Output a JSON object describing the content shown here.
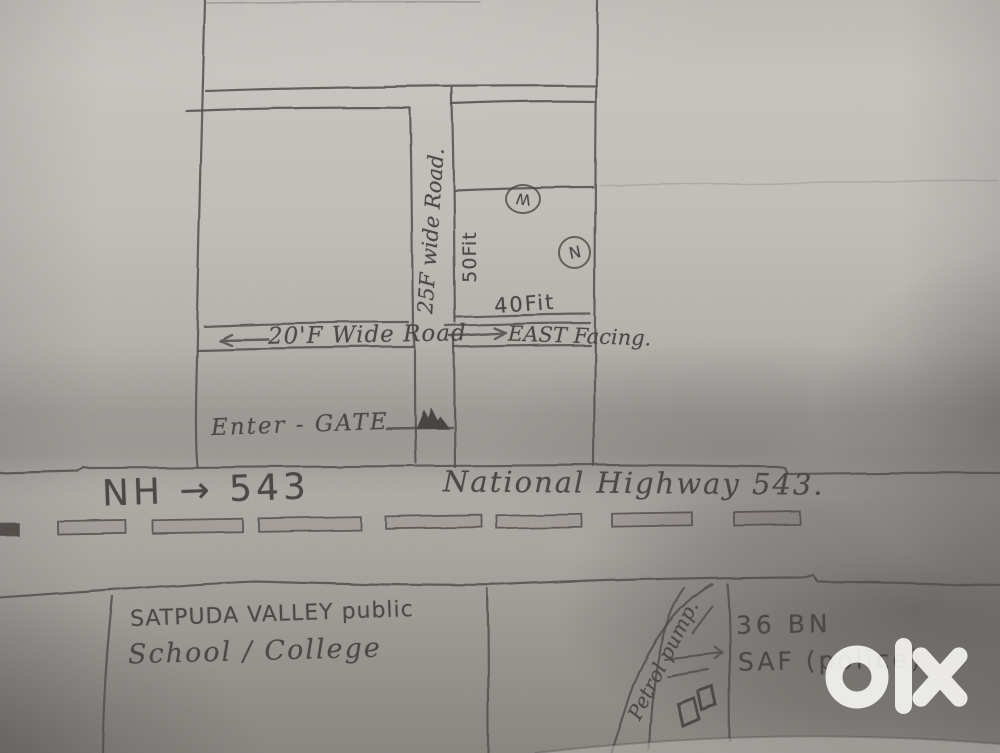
{
  "map": {
    "upper": {
      "vertical_road_label": "25F wide Road.",
      "depth_label": "50Fit",
      "width_label": "40Fit",
      "compass_west": "W",
      "compass_north": "N"
    },
    "middle_road": {
      "label": "20'F Wide Road",
      "facing_label": "EAST Facing.",
      "gate_label": "Enter - GATE"
    },
    "highway": {
      "short_label": "NH → 543",
      "full_label": "National Highway 543."
    },
    "bottom": {
      "school_line1": "SATPUDA VALLEY public",
      "school_line2": "School / College",
      "petrol_label": "Petrol pump.",
      "unit_line1": "36 BN",
      "unit_line2": "SAF (police)"
    },
    "watermark_logo": "olx"
  },
  "colors": {
    "paper": "#c6c2be",
    "pencil": "#544f4c",
    "watermark": "#fcfcfa"
  }
}
